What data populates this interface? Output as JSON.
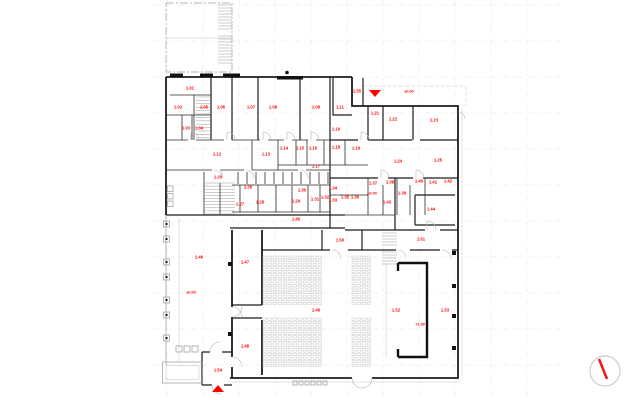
{
  "drawing": {
    "background": "#ffffff",
    "accent_red": "#ff0000",
    "wall_color": "#1c1c1c",
    "grid_color": "#e4e4e4",
    "annex_color": "#b4b4b4"
  },
  "room_labels": [
    {
      "text": "1.01",
      "x": 190,
      "y": 88
    },
    {
      "text": "1.02",
      "x": 178,
      "y": 107
    },
    {
      "text": "1.03",
      "x": 186,
      "y": 128
    },
    {
      "text": "1.04",
      "x": 199,
      "y": 128
    },
    {
      "text": "1.05",
      "x": 204,
      "y": 107
    },
    {
      "text": "1.06",
      "x": 221,
      "y": 107
    },
    {
      "text": "1.07",
      "x": 251,
      "y": 107
    },
    {
      "text": "1.08",
      "x": 273,
      "y": 107
    },
    {
      "text": "1.09",
      "x": 316,
      "y": 107
    },
    {
      "text": "1.10",
      "x": 336,
      "y": 129
    },
    {
      "text": "1.11",
      "x": 340,
      "y": 107
    },
    {
      "text": "1.12",
      "x": 217,
      "y": 154
    },
    {
      "text": "1.13",
      "x": 266,
      "y": 154
    },
    {
      "text": "1.14",
      "x": 284,
      "y": 148
    },
    {
      "text": "1.15",
      "x": 300,
      "y": 148
    },
    {
      "text": "1.16",
      "x": 313,
      "y": 148
    },
    {
      "text": "1.17",
      "x": 316,
      "y": 166
    },
    {
      "text": "1.18",
      "x": 336,
      "y": 147
    },
    {
      "text": "1.19",
      "x": 356,
      "y": 148
    },
    {
      "text": "1.20",
      "x": 218,
      "y": 177
    },
    {
      "text": "1.21",
      "x": 375,
      "y": 113
    },
    {
      "text": "1.22",
      "x": 393,
      "y": 119
    },
    {
      "text": "1.23",
      "x": 434,
      "y": 120
    },
    {
      "text": "1.24",
      "x": 398,
      "y": 161
    },
    {
      "text": "1.25",
      "x": 438,
      "y": 160
    },
    {
      "text": "1.26",
      "x": 248,
      "y": 187
    },
    {
      "text": "1.27",
      "x": 240,
      "y": 204
    },
    {
      "text": "1.28",
      "x": 260,
      "y": 202
    },
    {
      "text": "1.29",
      "x": 296,
      "y": 201
    },
    {
      "text": "1.30",
      "x": 302,
      "y": 190
    },
    {
      "text": "1.31",
      "x": 315,
      "y": 199
    },
    {
      "text": "1.32",
      "x": 325,
      "y": 197
    },
    {
      "text": "1.33",
      "x": 333,
      "y": 200
    },
    {
      "text": "1.34",
      "x": 333,
      "y": 188
    },
    {
      "text": "1.35",
      "x": 345,
      "y": 197
    },
    {
      "text": "1.36",
      "x": 355,
      "y": 197
    },
    {
      "text": "1.37",
      "x": 373,
      "y": 183
    },
    {
      "text": "1.38",
      "x": 390,
      "y": 182
    },
    {
      "text": "1.39",
      "x": 402,
      "y": 193
    },
    {
      "text": "1.40",
      "x": 419,
      "y": 181
    },
    {
      "text": "1.41",
      "x": 433,
      "y": 182
    },
    {
      "text": "1.42",
      "x": 448,
      "y": 181
    },
    {
      "text": "1.43",
      "x": 387,
      "y": 202
    },
    {
      "text": "1.44",
      "x": 431,
      "y": 209
    },
    {
      "text": "1.45",
      "x": 296,
      "y": 219
    },
    {
      "text": "1.46",
      "x": 199,
      "y": 257
    },
    {
      "text": "1.47",
      "x": 245,
      "y": 262
    },
    {
      "text": "1.48",
      "x": 245,
      "y": 346
    },
    {
      "text": "1.49",
      "x": 316,
      "y": 310
    },
    {
      "text": "1.50",
      "x": 340,
      "y": 240
    },
    {
      "text": "1.51",
      "x": 421,
      "y": 239
    },
    {
      "text": "1.52",
      "x": 396,
      "y": 310
    },
    {
      "text": "1.53",
      "x": 445,
      "y": 310
    },
    {
      "text": "1.54",
      "x": 218,
      "y": 370
    },
    {
      "text": "1.55",
      "x": 357,
      "y": 91
    }
  ],
  "elevation_labels": [
    {
      "text": "±0.00",
      "x": 409,
      "y": 91
    },
    {
      "text": "±0.00",
      "x": 372,
      "y": 193
    },
    {
      "text": "±0.00",
      "x": 191,
      "y": 292
    },
    {
      "text": "+1.00",
      "x": 420,
      "y": 324
    }
  ],
  "markers": {
    "entrance_top": {
      "shape": "triangle-down",
      "points": "369,90 381,90 375,97"
    },
    "entrance_bottom": {
      "shape": "triangle-up",
      "points": "212,392 224,392 218,385"
    }
  },
  "compass": {
    "cx": 605,
    "cy": 371,
    "r": 15,
    "needle_from": [
      599,
      359
    ],
    "needle_to": [
      607,
      379
    ]
  }
}
